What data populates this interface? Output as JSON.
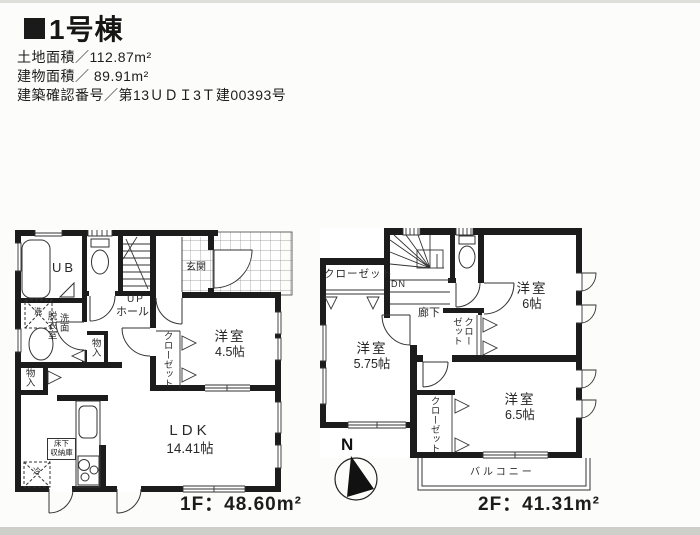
{
  "header": {
    "title": "1号棟",
    "land_area": "土地面積／112.87m²",
    "building_area": "建物面積／ 89.91m²",
    "confirmation_no": "建築確認番号／第13ＵＤＩ3Ｔ建00393号"
  },
  "floor1": {
    "area_label": "1F：48.60m²",
    "ub": "UB",
    "entrance": "玄関",
    "stairs_up": "UP",
    "hall": "ホール",
    "washroom_col_right": "洗面",
    "washroom_col_left": "脱衣室",
    "storage_hall": "物入",
    "storage_ldk": "物入",
    "closet": "クローゼット",
    "room_name": "洋室",
    "room_size": "4.5帖",
    "ldk_name": "LDK",
    "ldk_size": "14.41帖",
    "underfloor_line1": "床下",
    "underfloor_line2": "収納庫",
    "washer_mark": "洗",
    "fridge_mark": "冷"
  },
  "floor2": {
    "area_label": "2F：41.31m²",
    "closet_north": "クローゼット",
    "stairs_down": "DN",
    "corridor": "廊下",
    "room6_name": "洋室",
    "room6_size": "6帖",
    "closet_mid": "クローゼット",
    "room575_name": "洋室",
    "room575_size": "5.75帖",
    "room65_name": "洋室",
    "room65_size": "6.5帖",
    "closet_south": "クローゼット",
    "balcony": "バルコニー",
    "compass": "N"
  }
}
